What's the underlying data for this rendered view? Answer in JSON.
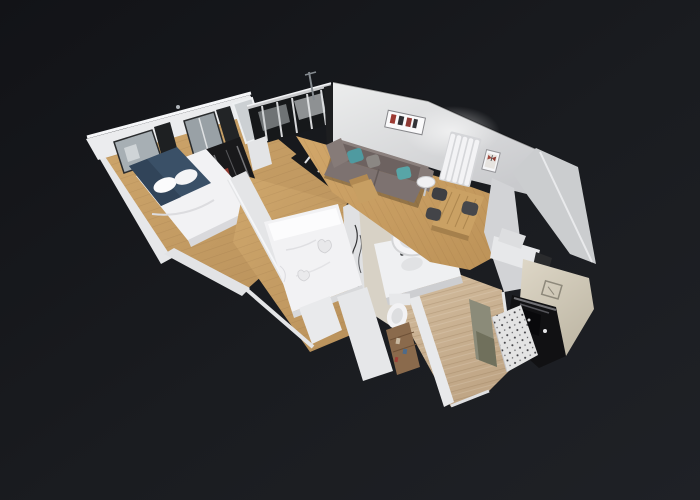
{
  "scene": {
    "type": "3d-dollhouse-view",
    "subject": "3D dollhouse scan of a one-bedroom apartment floating on a dark background",
    "background": {
      "corner_dark": "#121317",
      "center_dark": "#1f2126"
    },
    "palette": {
      "wood_left": "#cfa76c",
      "wood_living": "#d2a76a",
      "wood_hall": "#d6c0a2",
      "wall_white": "#eceded",
      "wall_shade": "#c9cacd",
      "glazing_dark": "#16181a",
      "sofa_gray_brown": "#6d6260",
      "pillow_teal": "#4f9aa0",
      "bed_linen_white": "#f2f2f4",
      "headboard_navy": "#3a5067",
      "dining_table_wood": "#caa164",
      "kitchen_dark": "#111113",
      "kitchen_steel_beige": "#ded7c7",
      "olive_wall": "#8b8b79",
      "tile_white": "#e3e3e3"
    },
    "rooms": [
      {
        "id": "bedroom-1",
        "label": "Bedroom with navy-accent double bed, black-framed windows and wardrobe",
        "position": "upper-left wing"
      },
      {
        "id": "entry",
        "label": "Entry with black-framed glass partition",
        "position": "top center"
      },
      {
        "id": "bedroom-2",
        "label": "Second bedroom with white double bed",
        "position": "center"
      },
      {
        "id": "bathroom",
        "label": "Bathroom with round basin, vanity and toilet",
        "position": "center right"
      },
      {
        "id": "living-dining",
        "label": "Living room with sofa, teal pillows, radiator, wall art and dining table",
        "position": "upper right wing"
      },
      {
        "id": "hallway",
        "label": "Wood-floor hallway",
        "position": "lower center"
      },
      {
        "id": "kitchen",
        "label": "Kitchen with dark appliances and speckled tile floor",
        "position": "lower right"
      }
    ]
  }
}
